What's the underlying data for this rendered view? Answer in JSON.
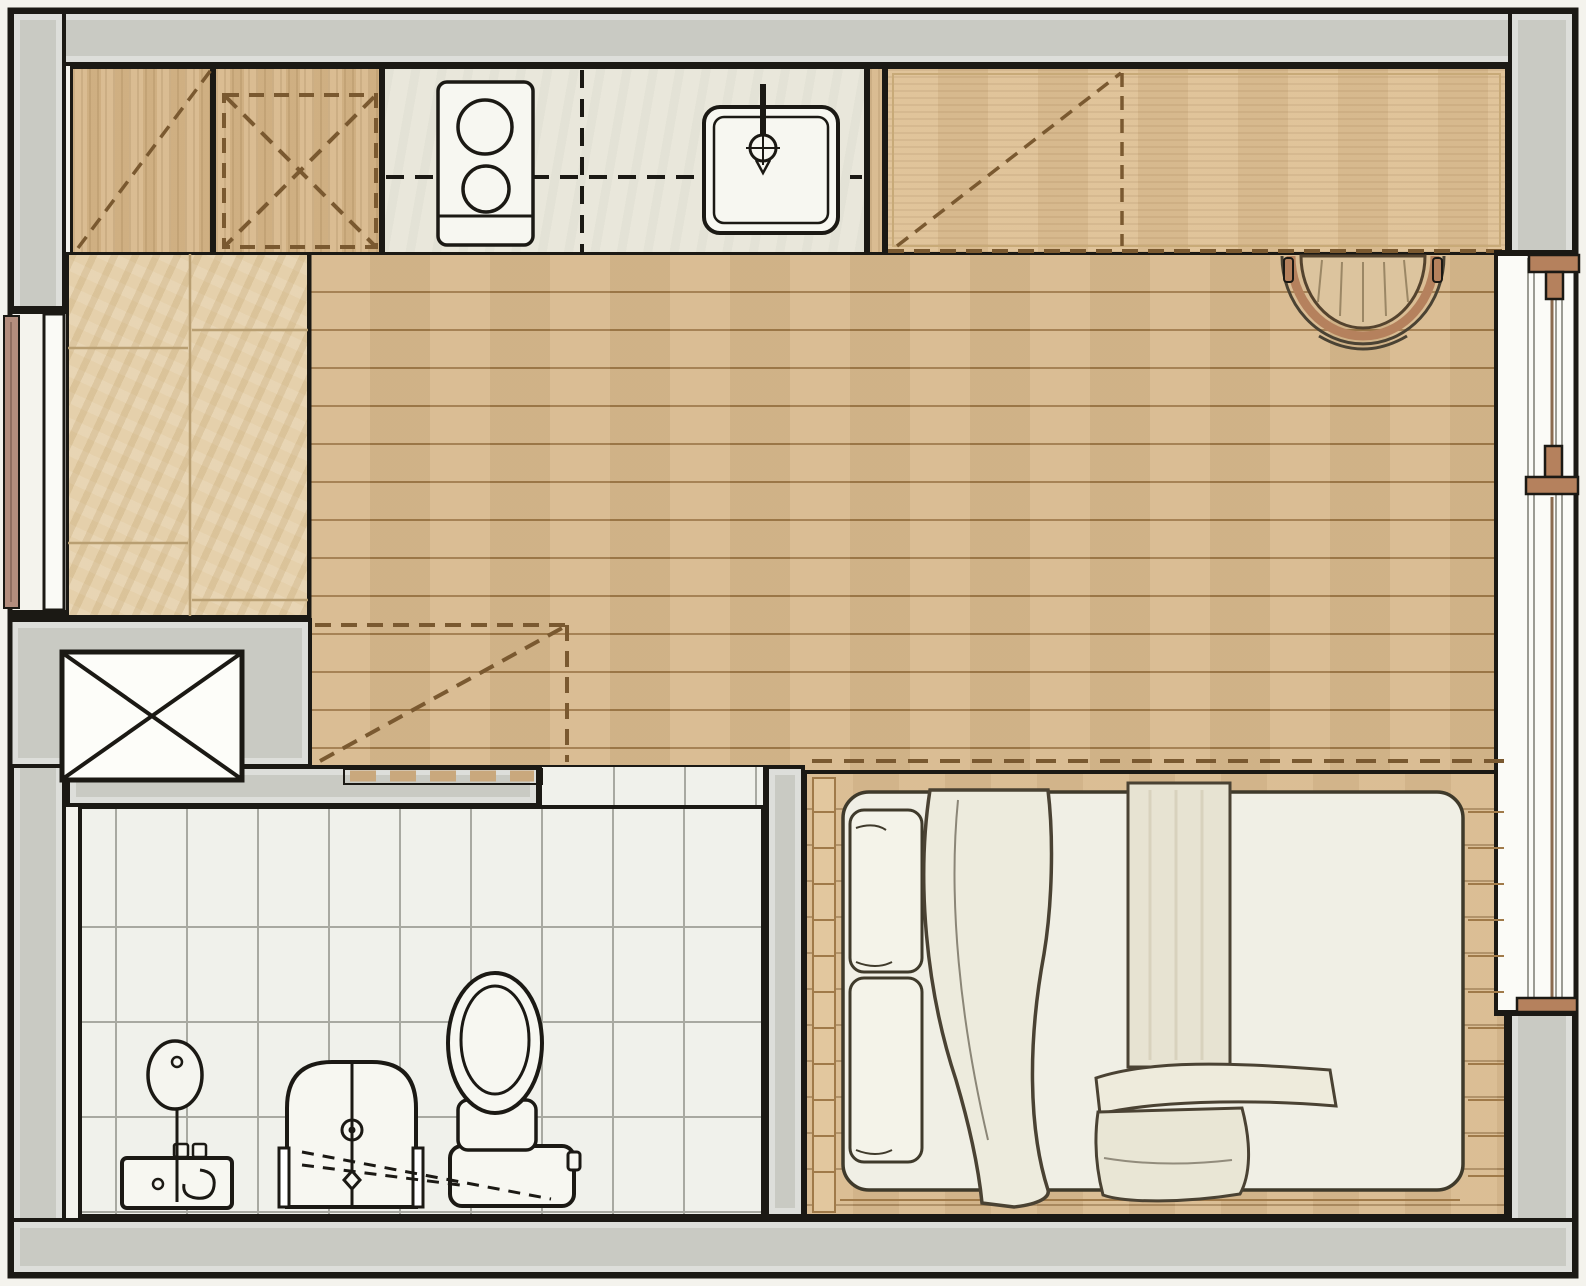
{
  "document": {
    "kind": "architectural-floor-plan",
    "view": "top-down studio apartment",
    "canvas": {
      "width": 1586,
      "height": 1286
    },
    "visible_text": []
  },
  "palette": {
    "bg": "#f4f3ed",
    "ink": "#1b1914",
    "wall": "#c9cac3",
    "wood": "#d7b88c",
    "woodLine": "#a07a49",
    "woodDash": "#7a5930",
    "cabinet": "#d6b586",
    "wardrobe": "#debf92",
    "wardrobeLine": "#c8aa78",
    "counter": "#e9e7db",
    "fixture": "#f7f7f1",
    "travertine": "#e2cba2",
    "travertineLine": "#b99f72",
    "tile": "#f0f1eb",
    "tileLine": "#a8a9a1",
    "deck": "#d9ba8e",
    "mattress": "#f0efe5",
    "fabric": "#eae7d8",
    "fabricInk": "#4a4233",
    "copper": "#b5815d",
    "doorLeaf": "#b38d7d",
    "glass": "#fbfbf7"
  },
  "rooms": [
    {
      "id": "kitchen",
      "floor": "stone counter and wood cabinets",
      "fixtures": [
        "upper-cabinets-dashed",
        "tall-cabinet-x",
        "two-burner-cooktop",
        "square-sink-with-faucet"
      ]
    },
    {
      "id": "living-area",
      "floor": "horizontal wood planks",
      "fixtures": [
        "dashed-overhead-storage",
        "barrel-chair"
      ]
    },
    {
      "id": "entry",
      "floor": "travertine tiles",
      "fixtures": [
        "entry-door-leaf",
        "service-shaft-x-box"
      ]
    },
    {
      "id": "bathroom",
      "floor": "white square tiles",
      "fixtures": [
        "vanity-with-round-mirror",
        "shower-enclosure",
        "toilet",
        "pocket-sliding-door",
        "slope-dashed-lines"
      ]
    },
    {
      "id": "sleeping-area",
      "floor": "wood deck platform",
      "fixtures": [
        "double-mattress",
        "two-pillows",
        "draped-blanket",
        "bed-runner",
        "folded-blankets"
      ]
    }
  ],
  "openings": [
    {
      "id": "entry-door",
      "wall": "left",
      "type": "door-leaf"
    },
    {
      "id": "balcony-window",
      "wall": "right",
      "type": "sliding-glass with copper handles"
    }
  ],
  "annotations": [
    "dashed diagonals = overhead / wall-mounted cabinetry",
    "dashed X squares = shafts or tall cabinets",
    "dashed track strip = pocket door"
  ]
}
